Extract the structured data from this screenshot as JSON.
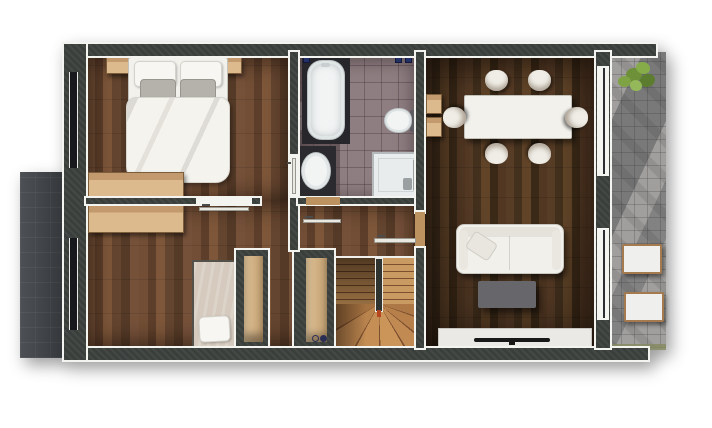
{
  "scene": {
    "type": "floor-plan-rendering",
    "description": "Top-down 3D rendered one-storey apartment floor plan on white background, no text labels",
    "orientation": "landscape"
  },
  "colors": {
    "wall": "#3a3f3c",
    "trim": "#f3f3ef",
    "tile": "#8e7e81",
    "stone": "#a19f9d",
    "balcony": "#43474b",
    "woodFloorDark": "#4c3421",
    "woodFloorMid": "#6a4832",
    "stairWood": "#c08a52",
    "furnitureWood": "#d8b88b",
    "fabricWhite": "#f2f1ec",
    "coffeeTableGray": "#67676b",
    "tvBlack": "#181818",
    "plantGreen": "#7fa344",
    "markerBlue": "#233068"
  },
  "rooms": [
    {
      "id": "bedroom-1",
      "floor": "dark wood planks",
      "furniture": [
        "double-bed with white duvet",
        "white pillow x2",
        "gray pillow x2",
        "nightstand x2",
        "wardrobe"
      ],
      "doors": [
        "door to hallway in right wall"
      ],
      "windows": [
        "full-height window to balcony"
      ]
    },
    {
      "id": "bedroom-2",
      "floor": "dark wood planks",
      "furniture": [
        "single-bed with beige blanket",
        "white pillow",
        "wardrobe",
        "open closet"
      ],
      "doors": [
        "door to hallway in top wall"
      ],
      "windows": [
        "full-height window to balcony"
      ]
    },
    {
      "id": "bathroom",
      "floor": "mauve tile",
      "fixtures": [
        "bathtub",
        "toilet",
        "washbasin",
        "shower"
      ],
      "markers": [
        "blue ceiling marker x3"
      ],
      "doors": [
        "door to hallway in bottom wall"
      ]
    },
    {
      "id": "hallway",
      "floor": "dark wood planks",
      "features": [
        "u-shaped winder staircase",
        "open closet",
        "power-outlet symbol"
      ]
    },
    {
      "id": "dining-living-room",
      "floor": "dark walnut planks",
      "furniture": [
        "white dining table",
        "dining chair x6",
        "wall shelf x2",
        "white sofa",
        "sofa cushion",
        "gray coffee table",
        "tv-stand",
        "tv"
      ],
      "doors": [
        "doorway from hallway"
      ],
      "windows": [
        "window to patio x2"
      ]
    },
    {
      "id": "balcony",
      "floor": "dark gray decking",
      "furniture": []
    },
    {
      "id": "patio",
      "floor": "gray stone pavers",
      "furniture": [
        "green plant",
        "outdoor seat x2"
      ],
      "edge": "grass strip"
    }
  ]
}
